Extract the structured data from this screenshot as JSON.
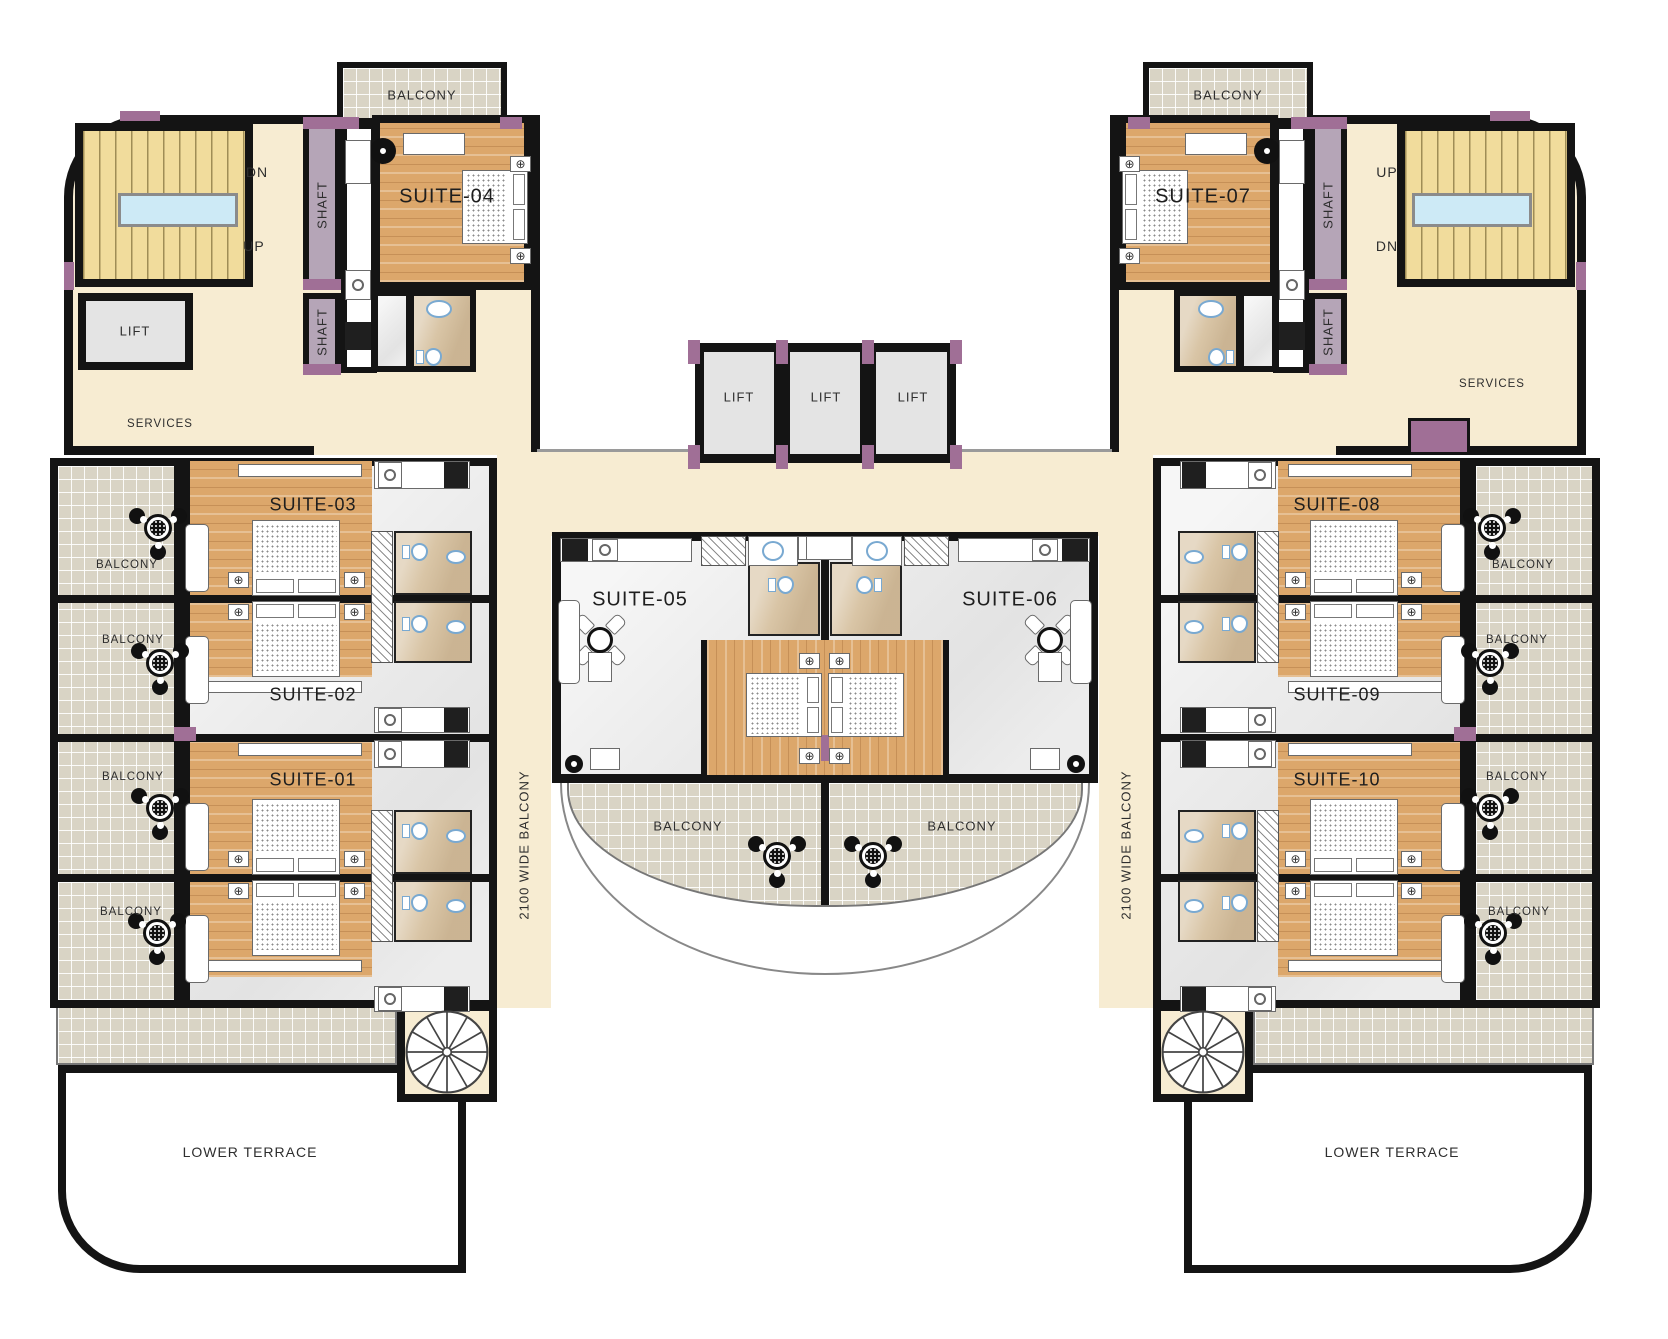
{
  "title": "Suites Floor Plan",
  "colors": {
    "wall": "#141414",
    "cream": "#f7ecd2",
    "stair": "#f1dc9c",
    "sky": "#cdeaf6",
    "lift": "#e4e4e4",
    "shaft": "#b5a5b7",
    "pier": "#a06f96",
    "wood": "#dca76b",
    "marble": "#ececec",
    "bath": "#d9c5a6",
    "tile": "#d9d4c5",
    "text": "#2e2e2e"
  },
  "icons": {
    "lamp": "⊕"
  },
  "labels": {
    "balcony": "BALCONY",
    "lift": "LIFT",
    "shaft": "SHAFT",
    "services": "SERVICES",
    "up": "UP",
    "dn": "DN",
    "wide_balcony": "2100 WIDE BALCONY",
    "lower_terrace": "LOWER TERRACE"
  },
  "suites": [
    {
      "id": "suite-01",
      "label": "SUITE-01"
    },
    {
      "id": "suite-02",
      "label": "SUITE-02"
    },
    {
      "id": "suite-03",
      "label": "SUITE-03"
    },
    {
      "id": "suite-04",
      "label": "SUITE-04"
    },
    {
      "id": "suite-05",
      "label": "SUITE-05"
    },
    {
      "id": "suite-06",
      "label": "SUITE-06"
    },
    {
      "id": "suite-07",
      "label": "SUITE-07"
    },
    {
      "id": "suite-08",
      "label": "SUITE-08"
    },
    {
      "id": "suite-09",
      "label": "SUITE-09"
    },
    {
      "id": "suite-10",
      "label": "SUITE-10"
    }
  ]
}
